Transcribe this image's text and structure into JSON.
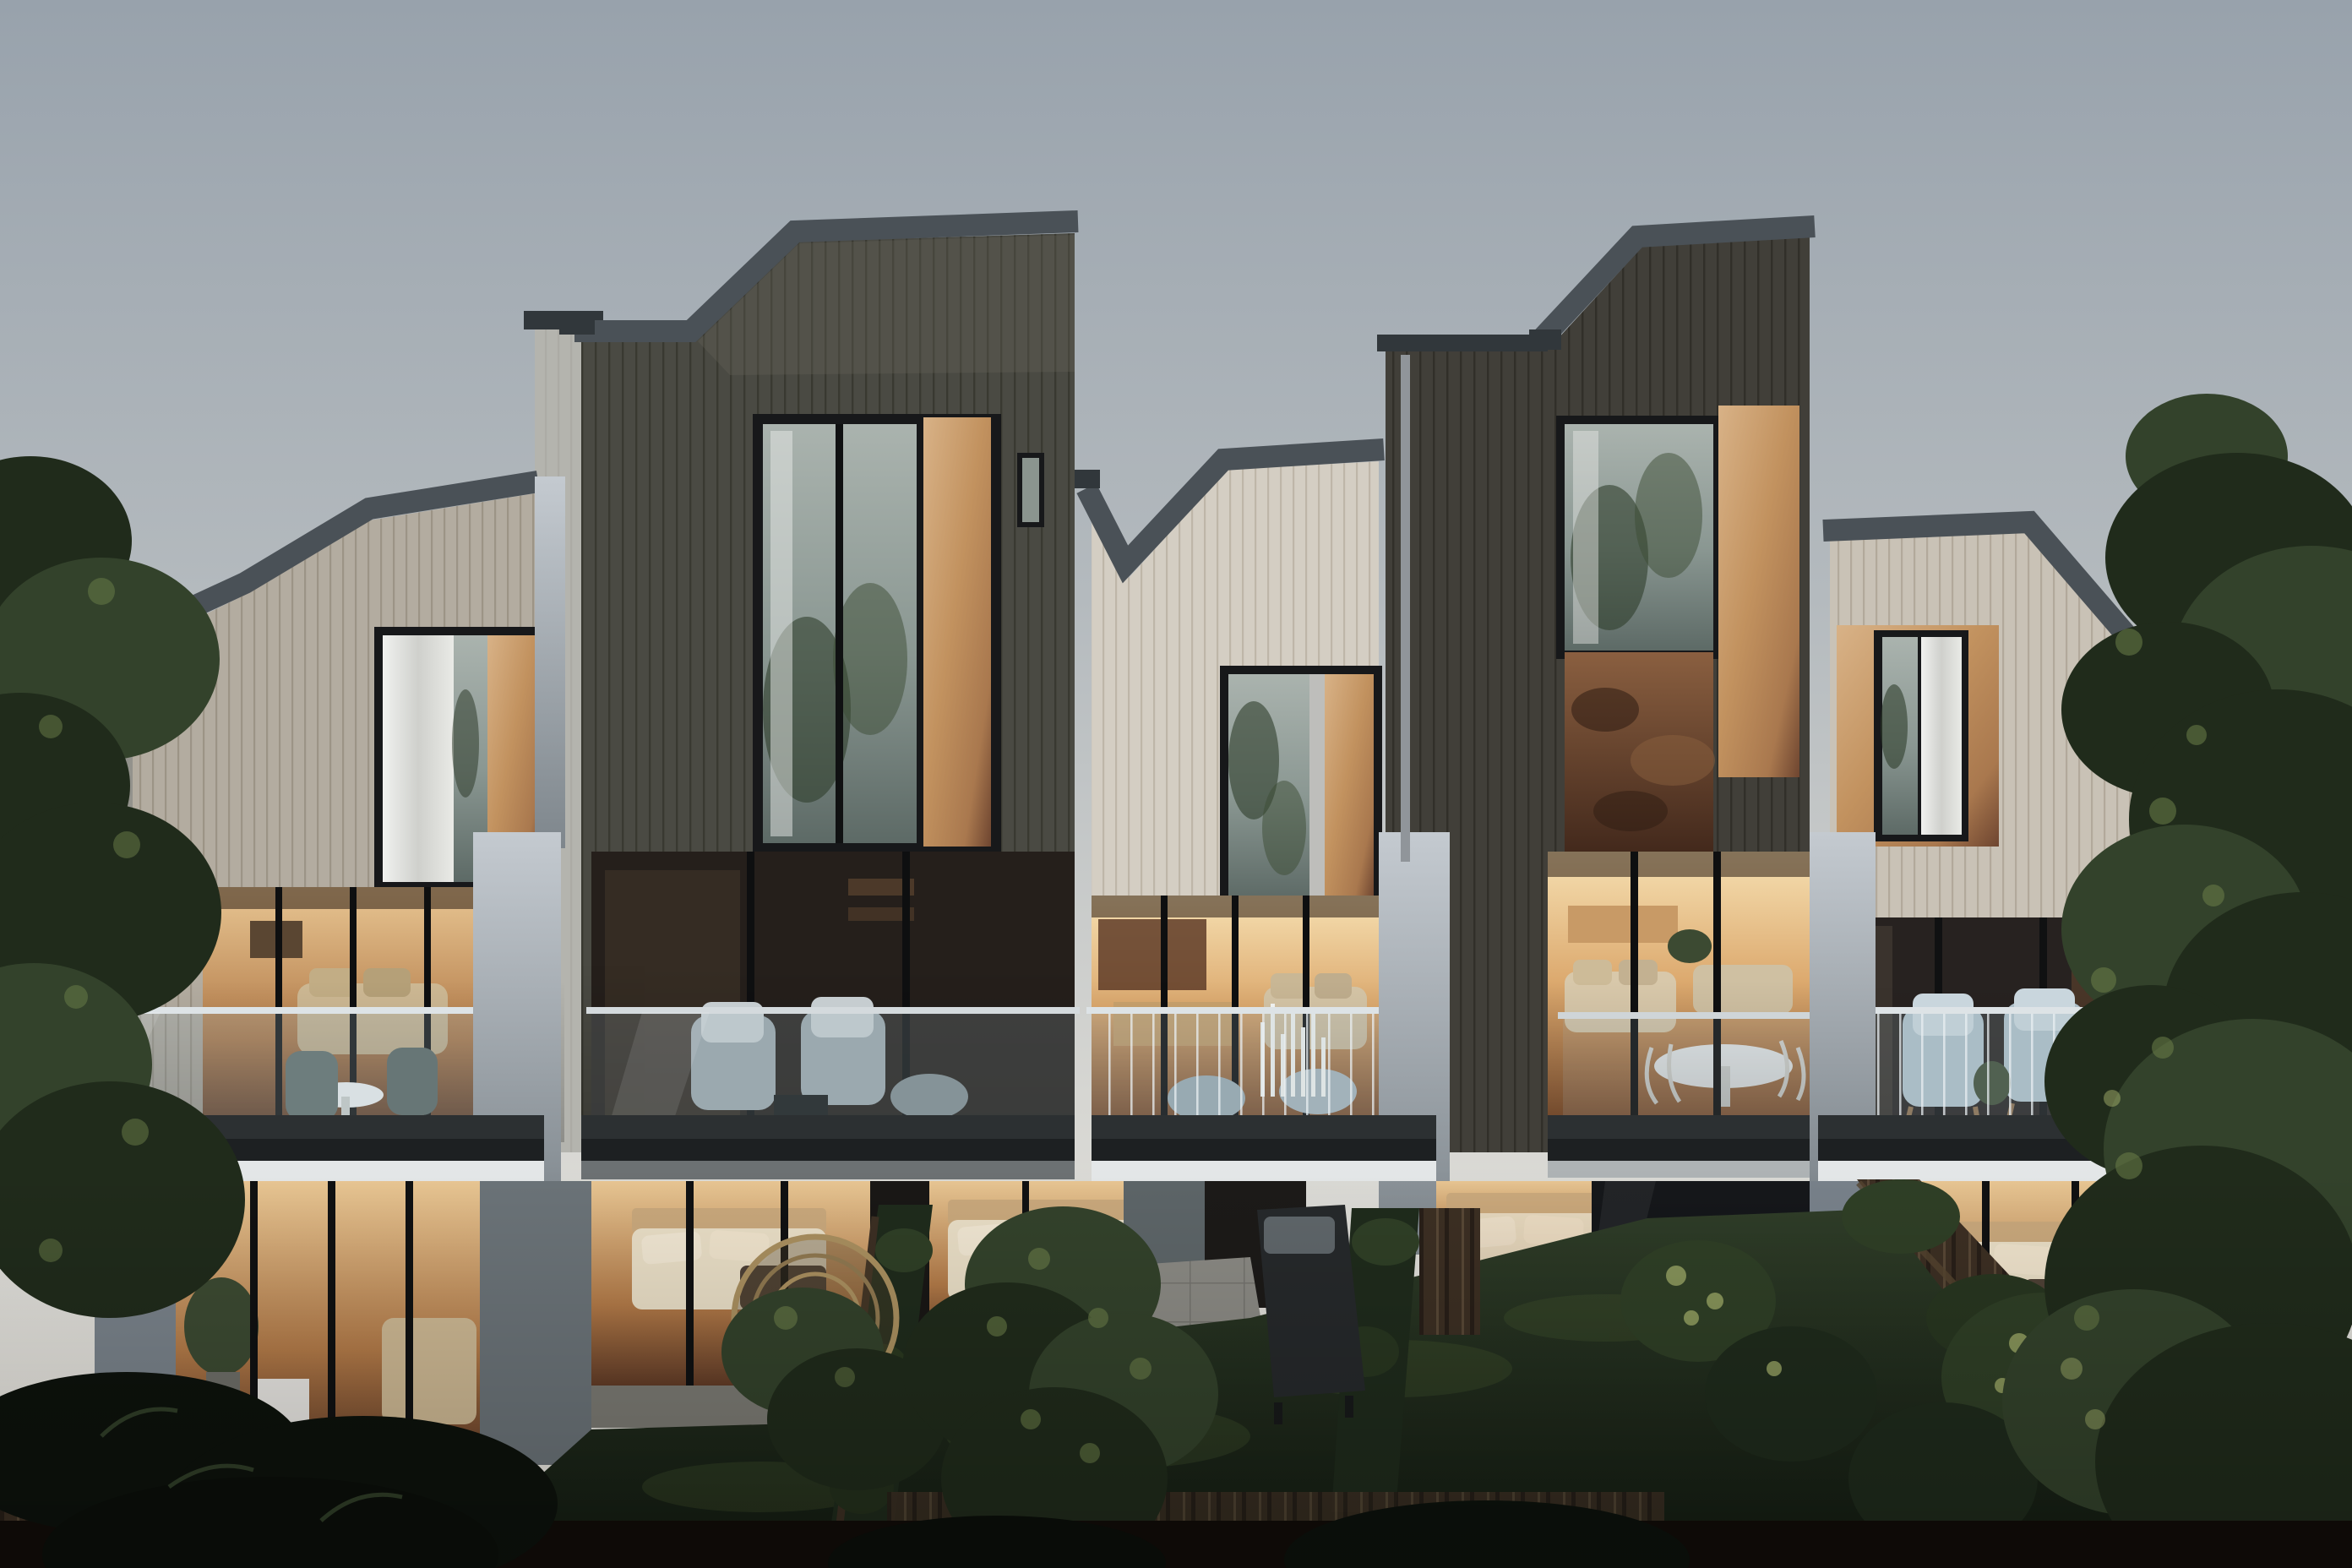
{
  "scene": {
    "type": "exterior architectural rendering",
    "time_of_day": "dusk",
    "subject": "Rear elevation of five modern terraced townhouses with warm lit interiors, glass balconies and private hedged gardens"
  },
  "units": [
    {
      "id": "unit-1",
      "cladding": "light grey timber battens",
      "roof": "mono-pitch parapet rising to the right",
      "features": [
        "upper window with curtain and bronze panel",
        "balcony with round cafe table and two chairs",
        "lit living room",
        "garden level lounge with potted plant and white cube table"
      ]
    },
    {
      "id": "unit-2",
      "cladding": "charcoal timber battens",
      "roof": "asymmetric gable, tallest volume",
      "features": [
        "double-height recess with bronze panel",
        "tall tree-reflecting window",
        "small side window",
        "balcony with two grey armchairs and ottoman",
        "garden level bedroom"
      ]
    },
    {
      "id": "unit-3",
      "cladding": "cream timber battens",
      "roof": "stepped valley parapet",
      "features": [
        "window with bronze panel",
        "lit kitchen and sofa",
        "balcony with two ottomans and cluster of candles",
        "garden level bedroom",
        "paved patio"
      ]
    },
    {
      "id": "unit-4",
      "cladding": "charcoal timber battens",
      "roof": "asymmetric gable",
      "features": [
        "tree-reflecting corner window with bronze panel",
        "weathered copper spandrel",
        "open-plan living with white round dining table and wire chairs",
        "terrace",
        "garden level bedroom"
      ]
    },
    {
      "id": "unit-5",
      "cladding": "pale timber battens",
      "roof": "parapet falling to the right",
      "features": [
        "bronze-surround window",
        "balcony with two pale blue armchairs",
        "garden level bedroom",
        "angled paved patio"
      ]
    }
  ],
  "garden": {
    "elements": [
      "clipped box hedges",
      "dark timber boundary fences",
      "lawns",
      "rattan egg chair",
      "black sun lounger",
      "paved patios",
      "mature screening trees left and right",
      "small garden trees"
    ]
  },
  "colors": {
    "sky-top": "#98a2ac",
    "sky-mid": "#b4babe",
    "sky-low": "#d6d6d2",
    "sky-horizon": "#ece9e2",
    "hill-blue": "#5e7387",
    "clad-light": "#b3aca0",
    "clad-light-line": "#9c9486",
    "clad-cream": "#d4cec3",
    "clad-cream-line": "#beb6a8",
    "clad-light2": "#c9c2b6",
    "clad-light2-line": "#b2a99b",
    "clad-dark": "#4a4a43",
    "clad-dark-line": "#393931",
    "clad-dark2": "#413f39",
    "clad-dark2-line": "#312f29",
    "roof-trim": "#4a5157",
    "roof-trim-dark": "#31373b",
    "copper-hi": "#d8b287",
    "copper-mid": "#a9784e",
    "copper-lo": "#6e4530",
    "copper-rust": "#6b4227",
    "curtain": "#e6e7e5",
    "frame-dark": "#17181a",
    "glass-cool": "#8a9792",
    "glass-cool-dark": "#5d6a66",
    "room-glow-hi": "#f6e0b2",
    "room-glow-mid": "#dca96e",
    "room-glow-lo": "#7c4b2c",
    "room-dim": "#262019",
    "concrete-hi": "#c4cad0",
    "concrete-lo": "#7e868c",
    "soffit-white": "#e4e7e8",
    "deck-dark": "#2c3032",
    "fascia-dark": "#1d2022",
    "balustrade-tint": "#9fb4bd",
    "baluster-line": "#e9eff1",
    "lawn-hi": "#2f3d28",
    "lawn-lo": "#121a11",
    "hedge-dark": "#1f2b1c",
    "hedge-mid": "#2f3f26",
    "foliage-lit": "#6c7f49",
    "foliage-bright": "#a3af6b",
    "tree-dark": "#202b1b",
    "tree-mid": "#33422b",
    "fence-dark": "#281f18",
    "fence-mid": "#3c2f23",
    "fence-lit": "#6a5843",
    "trunk": "#241b12",
    "furn-gray": "#9aa6ab",
    "furn-blue": "#aebfc8",
    "furn-tan": "#cdb893",
    "furn-white": "#eceff0",
    "wood-warm": "#b97f4e"
  }
}
